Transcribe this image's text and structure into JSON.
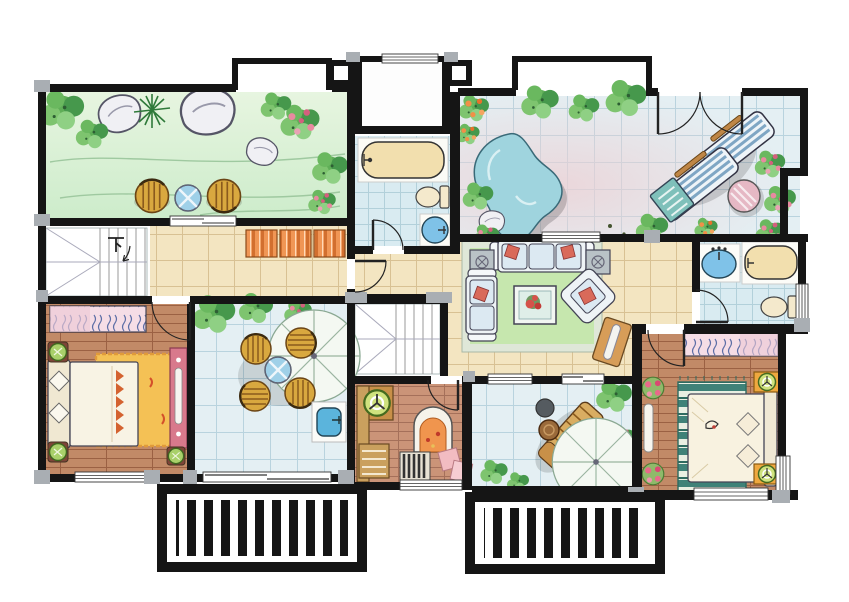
{
  "plan": {
    "title": "Hand-rendered residential floor plan",
    "labels": {
      "stairs_down": "下"
    },
    "palette": {
      "wall": "#151515",
      "column": "#a9aeb3",
      "paper": "#ffffff",
      "tanTile": "#f3e5c1",
      "tanLine": "#d8c193",
      "terraceTile": "#e4eff3",
      "terraceLine": "#b9d3de",
      "bathTile": "#d9ebf1",
      "bathLine": "#b2d0da",
      "woodFloor": "#c28a67",
      "woodLine": "#9b6143",
      "studyWood": "#cb9478",
      "lawn": "#d9f0d3",
      "foliage": "#5fae57",
      "flowerPink": "#e88aa0",
      "flowerOrange": "#f09048",
      "closetOrange": "#f09655",
      "rugGreen": "#c6e7ae",
      "rugOrange": "#f4c155",
      "rugTeal": "#3f8278",
      "dresserPink": "#d8798c",
      "fixtureBlue": "#7fc2e8",
      "tubCream": "#f2dfae",
      "rattan": "#d9a83f",
      "loungerBlue": "#7fa6c4",
      "sofaBlue": "#dce9f2",
      "pillowRed": "#d96a5a"
    },
    "rooms": [
      {
        "id": "garden-terrace-nw",
        "label": "landscaped garden terrace"
      },
      {
        "id": "entry-niche",
        "label": "entry niche"
      },
      {
        "id": "bathroom-center",
        "label": "bathroom with tub"
      },
      {
        "id": "terrace-ne",
        "label": "terrace with pond and sun loungers"
      },
      {
        "id": "bathroom-east",
        "label": "bathroom"
      },
      {
        "id": "living-room",
        "label": "family sitting room"
      },
      {
        "id": "corridor",
        "label": "hallway with closets"
      },
      {
        "id": "stairs-main",
        "label": "staircase going down"
      },
      {
        "id": "bedroom-west",
        "label": "bedroom"
      },
      {
        "id": "terrace-center",
        "label": "patio with parasol and chairs"
      },
      {
        "id": "stairs-secondary",
        "label": "secondary stair"
      },
      {
        "id": "study",
        "label": "study with hearth"
      },
      {
        "id": "terrace-south",
        "label": "patio with lounge chair"
      },
      {
        "id": "bedroom-southeast",
        "label": "master bedroom"
      },
      {
        "id": "pergola-southwest",
        "label": "pergola trellis"
      },
      {
        "id": "pergola-south",
        "label": "pergola trellis"
      }
    ]
  }
}
